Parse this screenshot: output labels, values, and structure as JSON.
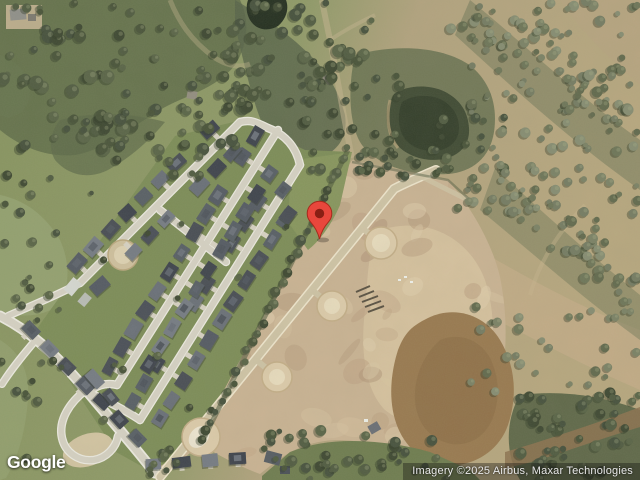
{
  "app": {
    "name": "satellite-map-view"
  },
  "branding": {
    "logo_text": "Google"
  },
  "attribution": {
    "text": "Imagery ©2025 Airbus, Maxar Technologies"
  },
  "marker": {
    "name": "red-location-pin",
    "color": "#E8473C",
    "stroke_color": "#A62A1C",
    "inner_color": "#8A1F14"
  },
  "terrain_colors": {
    "vegetation": "#7d8d58",
    "woodland": "#5b6847",
    "scrub": "#b3a17e",
    "graded_dirt": "#c9b393",
    "road": "#d6d2c4",
    "pond_water": "#404b34",
    "muddy_water": "#997a50"
  }
}
